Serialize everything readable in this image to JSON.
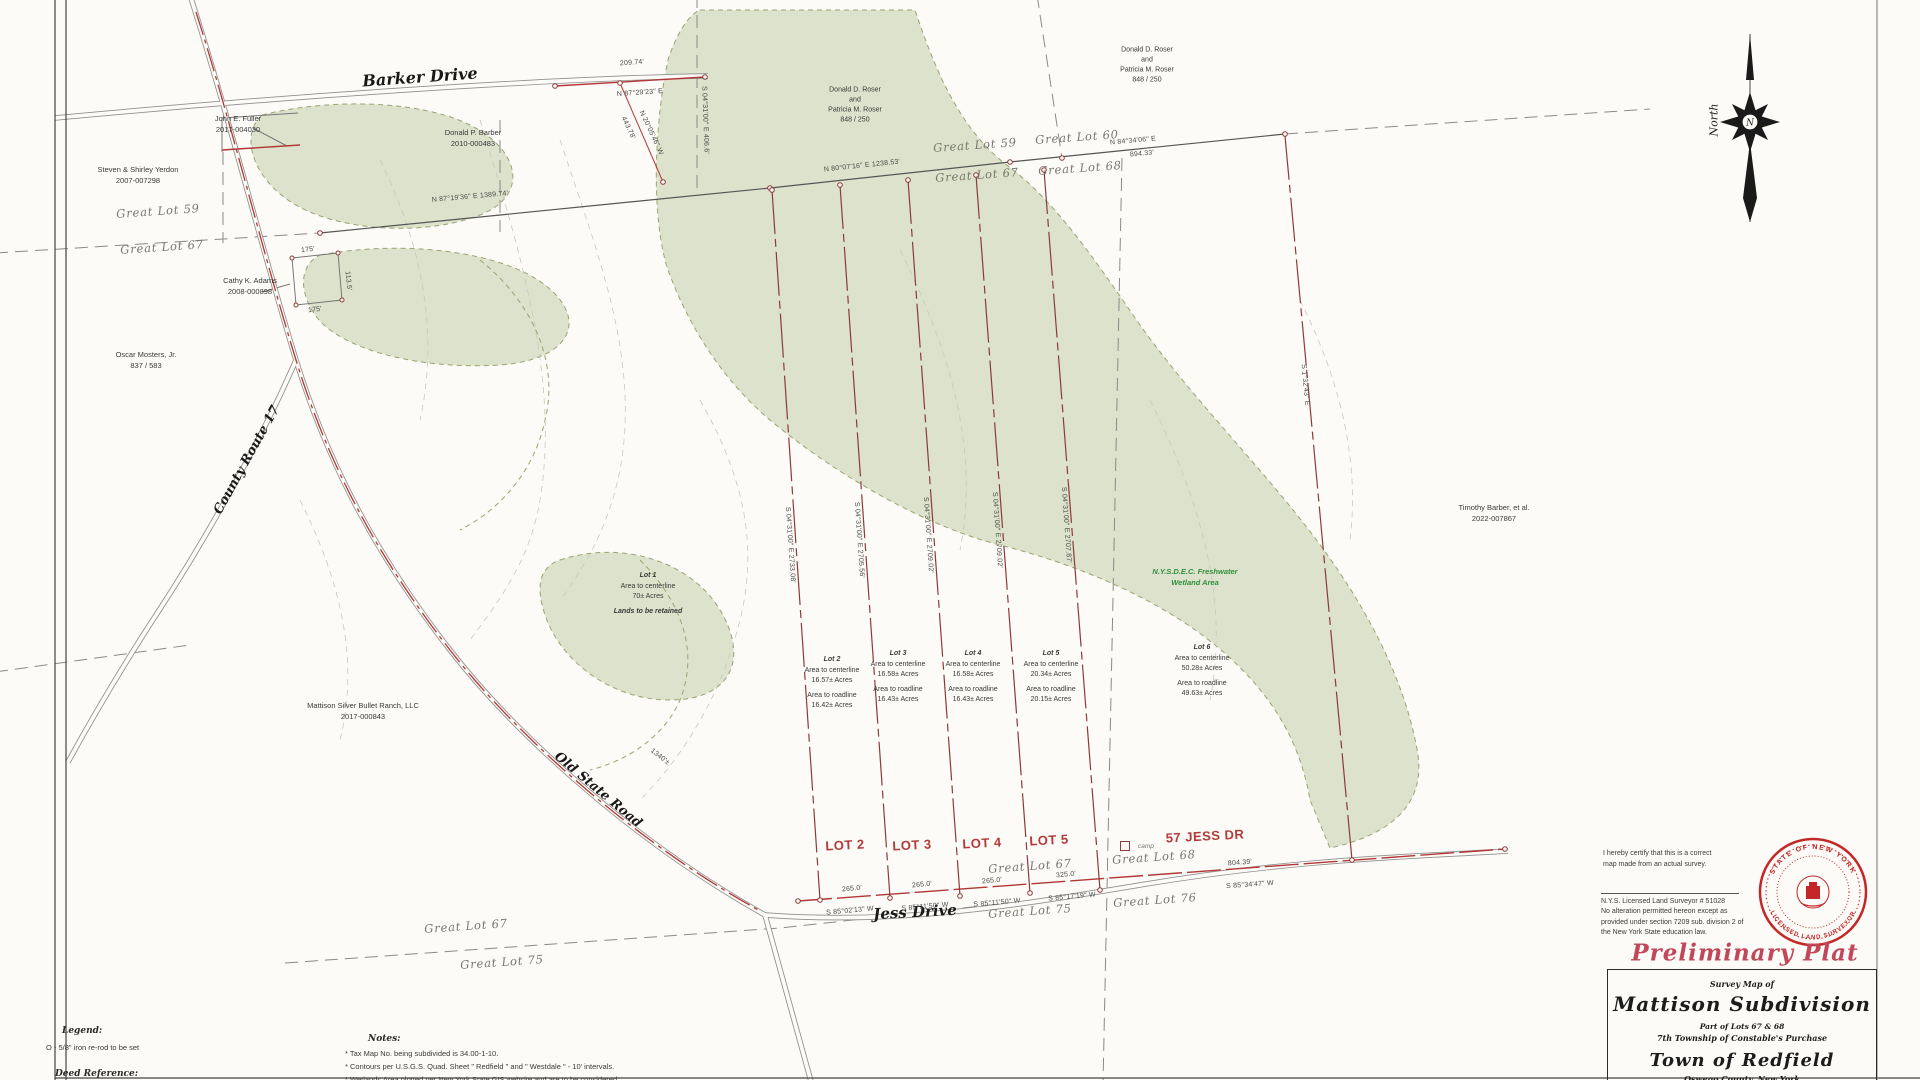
{
  "sheet_title": {
    "preliminary_plat": "Preliminary Plat",
    "survey_map_of": "Survey Map of",
    "subdivision": "Mattison Subdivision",
    "part_of": "Part of Lots 67 & 68",
    "township": "7th Township of Constable's Purchase",
    "town": "Town of Redfield",
    "county": "Oswego County, New York"
  },
  "certification": {
    "statement": "I hereby certify that this is a correct map made from an actual survey.",
    "surveyor_line": "N.Y.S. Licensed Land Surveyor # 51028",
    "alteration_note": "No alteration permitted hereon except as provided under section 7209 sub. division 2 of the New York State education law."
  },
  "seal": {
    "top_text": "STATE OF NEW YORK",
    "bottom_text": "LICENSED LAND SURVEYOR"
  },
  "north_arrow": {
    "label": "North",
    "center_letter": "N"
  },
  "legend": {
    "heading": "Legend:",
    "iron_rod": "O - 5/8\" iron re-rod to be set",
    "deed_reference": "Deed Reference:"
  },
  "notes": {
    "heading": "Notes:",
    "items": [
      "* Tax Map No. being subdivided is 34.00-1-10.",
      "* Contours per U.S.G.S. Quad. Sheet \" Redfield \" and \" Westdale \" - 10' intervals.",
      "* Wetlands Area plotted per New York State GIS website and are to be considered"
    ]
  },
  "roads": {
    "barker": "Barker Drive",
    "county_route": "County Route 17",
    "old_state": "Old State Road",
    "jess": "Jess Drive"
  },
  "red_lot_labels": [
    "LOT 2",
    "LOT 3",
    "LOT 4",
    "LOT 5",
    "57 JESS DR"
  ],
  "camp_label": "camp",
  "wetland_note": {
    "line1": "N.Y.S.D.E.C. Freshwater",
    "line2": "Wetland Area"
  },
  "great_lot_labels": [
    "Great Lot 59",
    "Great Lot 67",
    "Great Lot 59",
    "Great Lot 60",
    "Great Lot 67",
    "Great Lot 68",
    "Great Lot 67",
    "Great Lot 68",
    "Great Lot 75",
    "Great Lot 76",
    "Great Lot 67",
    "Great Lot 75"
  ],
  "owners": [
    {
      "lines": [
        "John E. Fuller",
        "2017-004030"
      ]
    },
    {
      "lines": [
        "Steven & Shirley Yerdon",
        "2007-007298"
      ]
    },
    {
      "lines": [
        "Cathy K. Adams",
        "2008-000898"
      ]
    },
    {
      "lines": [
        "Oscar Mosters, Jr.",
        "837 / 583"
      ]
    },
    {
      "lines": [
        "Donald P. Barber",
        "2010-000483"
      ]
    },
    {
      "lines": [
        "Donald D. Roser",
        "and",
        "Patricia M. Roser",
        "848 / 250"
      ]
    },
    {
      "lines": [
        "Donald D. Roser",
        "and",
        "Patricia M. Roser",
        "848 / 250"
      ]
    },
    {
      "lines": [
        "Timothy Barber, et al.",
        "2022-007867"
      ]
    },
    {
      "lines": [
        "Mattison Silver Bullet Ranch, LLC",
        "2017-000843"
      ]
    }
  ],
  "lots": [
    {
      "name": "Lot 1",
      "rows": [
        "Area to centerline",
        "70± Acres"
      ],
      "note": "Lands to be retained"
    },
    {
      "name": "Lot 2",
      "rows": [
        "Area to centerline",
        "16.57± Acres",
        "Area to roadline",
        "16.42± Acres"
      ]
    },
    {
      "name": "Lot 3",
      "rows": [
        "Area to centerline",
        "16.58± Acres",
        "Area to roadline",
        "16.43± Acres"
      ]
    },
    {
      "name": "Lot 4",
      "rows": [
        "Area to centerline",
        "16.58± Acres",
        "Area to roadline",
        "16.43± Acres"
      ]
    },
    {
      "name": "Lot 5",
      "rows": [
        "Area to centerline",
        "20.34± Acres",
        "Area to roadline",
        "20.15± Acres"
      ]
    },
    {
      "name": "Lot 6",
      "rows": [
        "Area to centerline",
        "50.28± Acres",
        "Area to roadline",
        "49.63± Acres"
      ]
    }
  ],
  "bearings": [
    "209.74'",
    "N 87°29'23\" E",
    "N 87°19'36\" E   1389.74'",
    "N 80°07'16\" E   1238.53'",
    "N 84°34'06\" E",
    "894.33'",
    "443.78'",
    "N 20°05'46\" W",
    "S 04°31'00\" E  406.6'",
    "S 04°31'00\" E   2733.08'",
    "S 04°31'00\" E   2705.56'",
    "S 04°31'00\" E   2709.02'",
    "S 04°31'00\" E   2709.02'",
    "S 04°31'00\" E   2707.87'",
    "S 1°32'43\" E",
    "265.0'",
    "S 85°02'13\" W",
    "265.0'",
    "S 85°11'50\" W",
    "265.0'",
    "S 85°11'50\" W",
    "325.0'",
    "S 85°17'19\" W",
    "804.39'",
    "S 85°34'47\" W",
    "175'",
    "175'",
    "113.5'",
    "1340'±"
  ]
}
